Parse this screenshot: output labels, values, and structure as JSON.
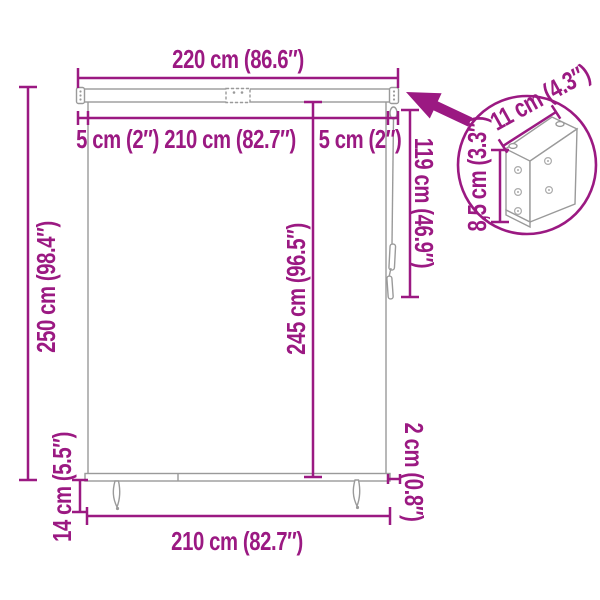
{
  "accent_color": "#9B1982",
  "outline_color": "#9A9A9A",
  "diagram": {
    "type": "product-dimension-diagram",
    "product": "roller blind with mounting bracket detail",
    "dimensions": {
      "total_width": "220 cm (86.6″)",
      "side_margin_and_fabric_width": "5 cm (2″) 210 cm (82.7″)",
      "side_margin_right": "5 cm (2″)",
      "total_height": "250 cm (98.4″)",
      "fabric_drop": "245 cm (96.5″)",
      "cord_length": "119 cm (46.9″)",
      "bracket_width_detail": "11 cm (4.3″)",
      "bracket_height_detail": "8,5 cm (3.3″)",
      "bottom_clearance": "14 cm (5.5″)",
      "bottom_bar_thickness": "2 cm (0.8″)",
      "fabric_width_bottom": "210 cm (82.7″)"
    }
  }
}
